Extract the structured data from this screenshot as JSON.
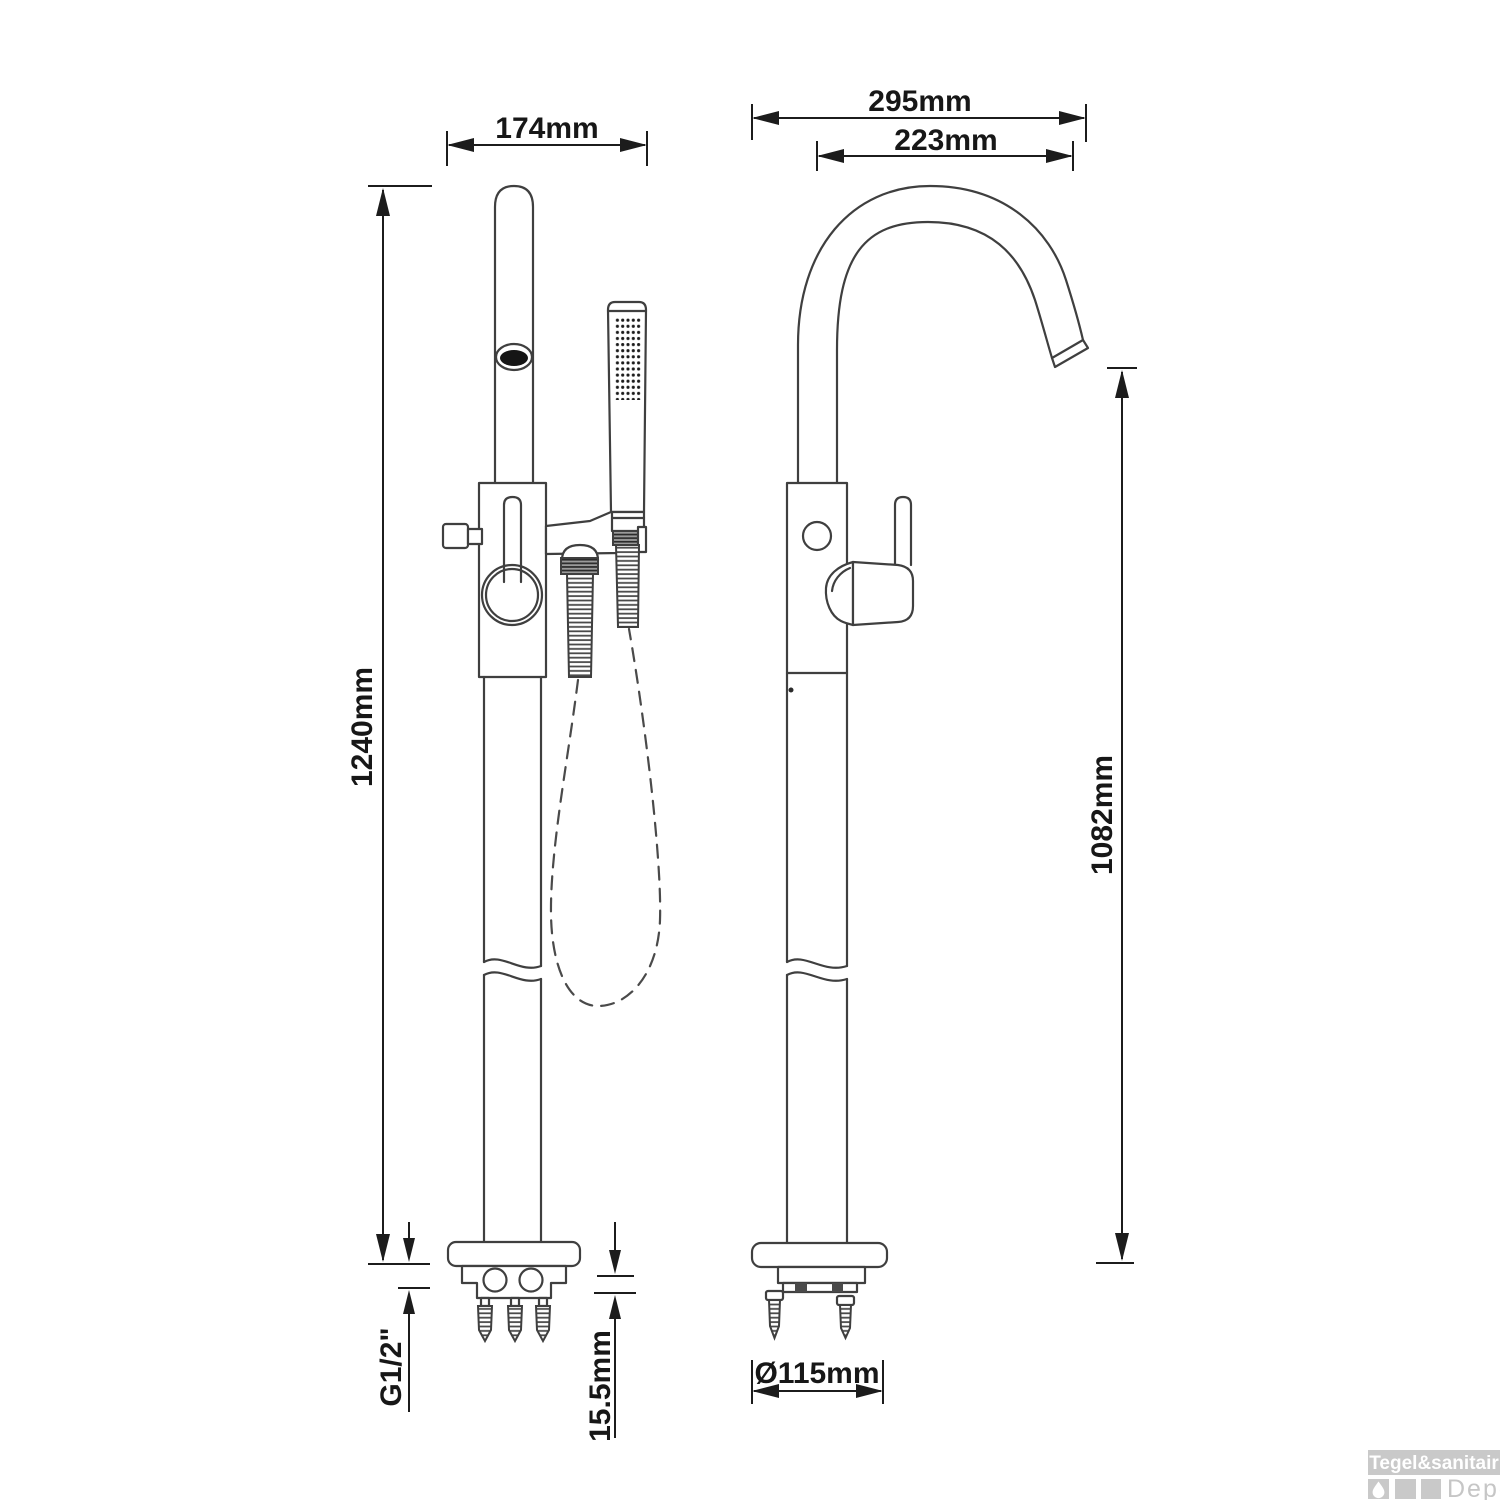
{
  "diagram": {
    "title_semantic": "freestanding-bath-mixer-dimension-drawing",
    "side_view": {
      "dim_top_width": "174mm",
      "dim_total_height": "1240mm",
      "dim_thread": "G1/2\"",
      "dim_plate_thickness": "15.5mm"
    },
    "front_view": {
      "dim_spout_reach_outer": "295mm",
      "dim_spout_reach_inner": "223mm",
      "dim_spout_height": "1082mm",
      "dim_base_diameter": "Ø115mm"
    }
  },
  "watermark": {
    "brand": "Tegel&sanitair",
    "suffix": "Depot"
  },
  "colors": {
    "line": "#3f3f3f",
    "dimension": "#1c1c1c",
    "watermark_gray": "#c9c9c9"
  }
}
